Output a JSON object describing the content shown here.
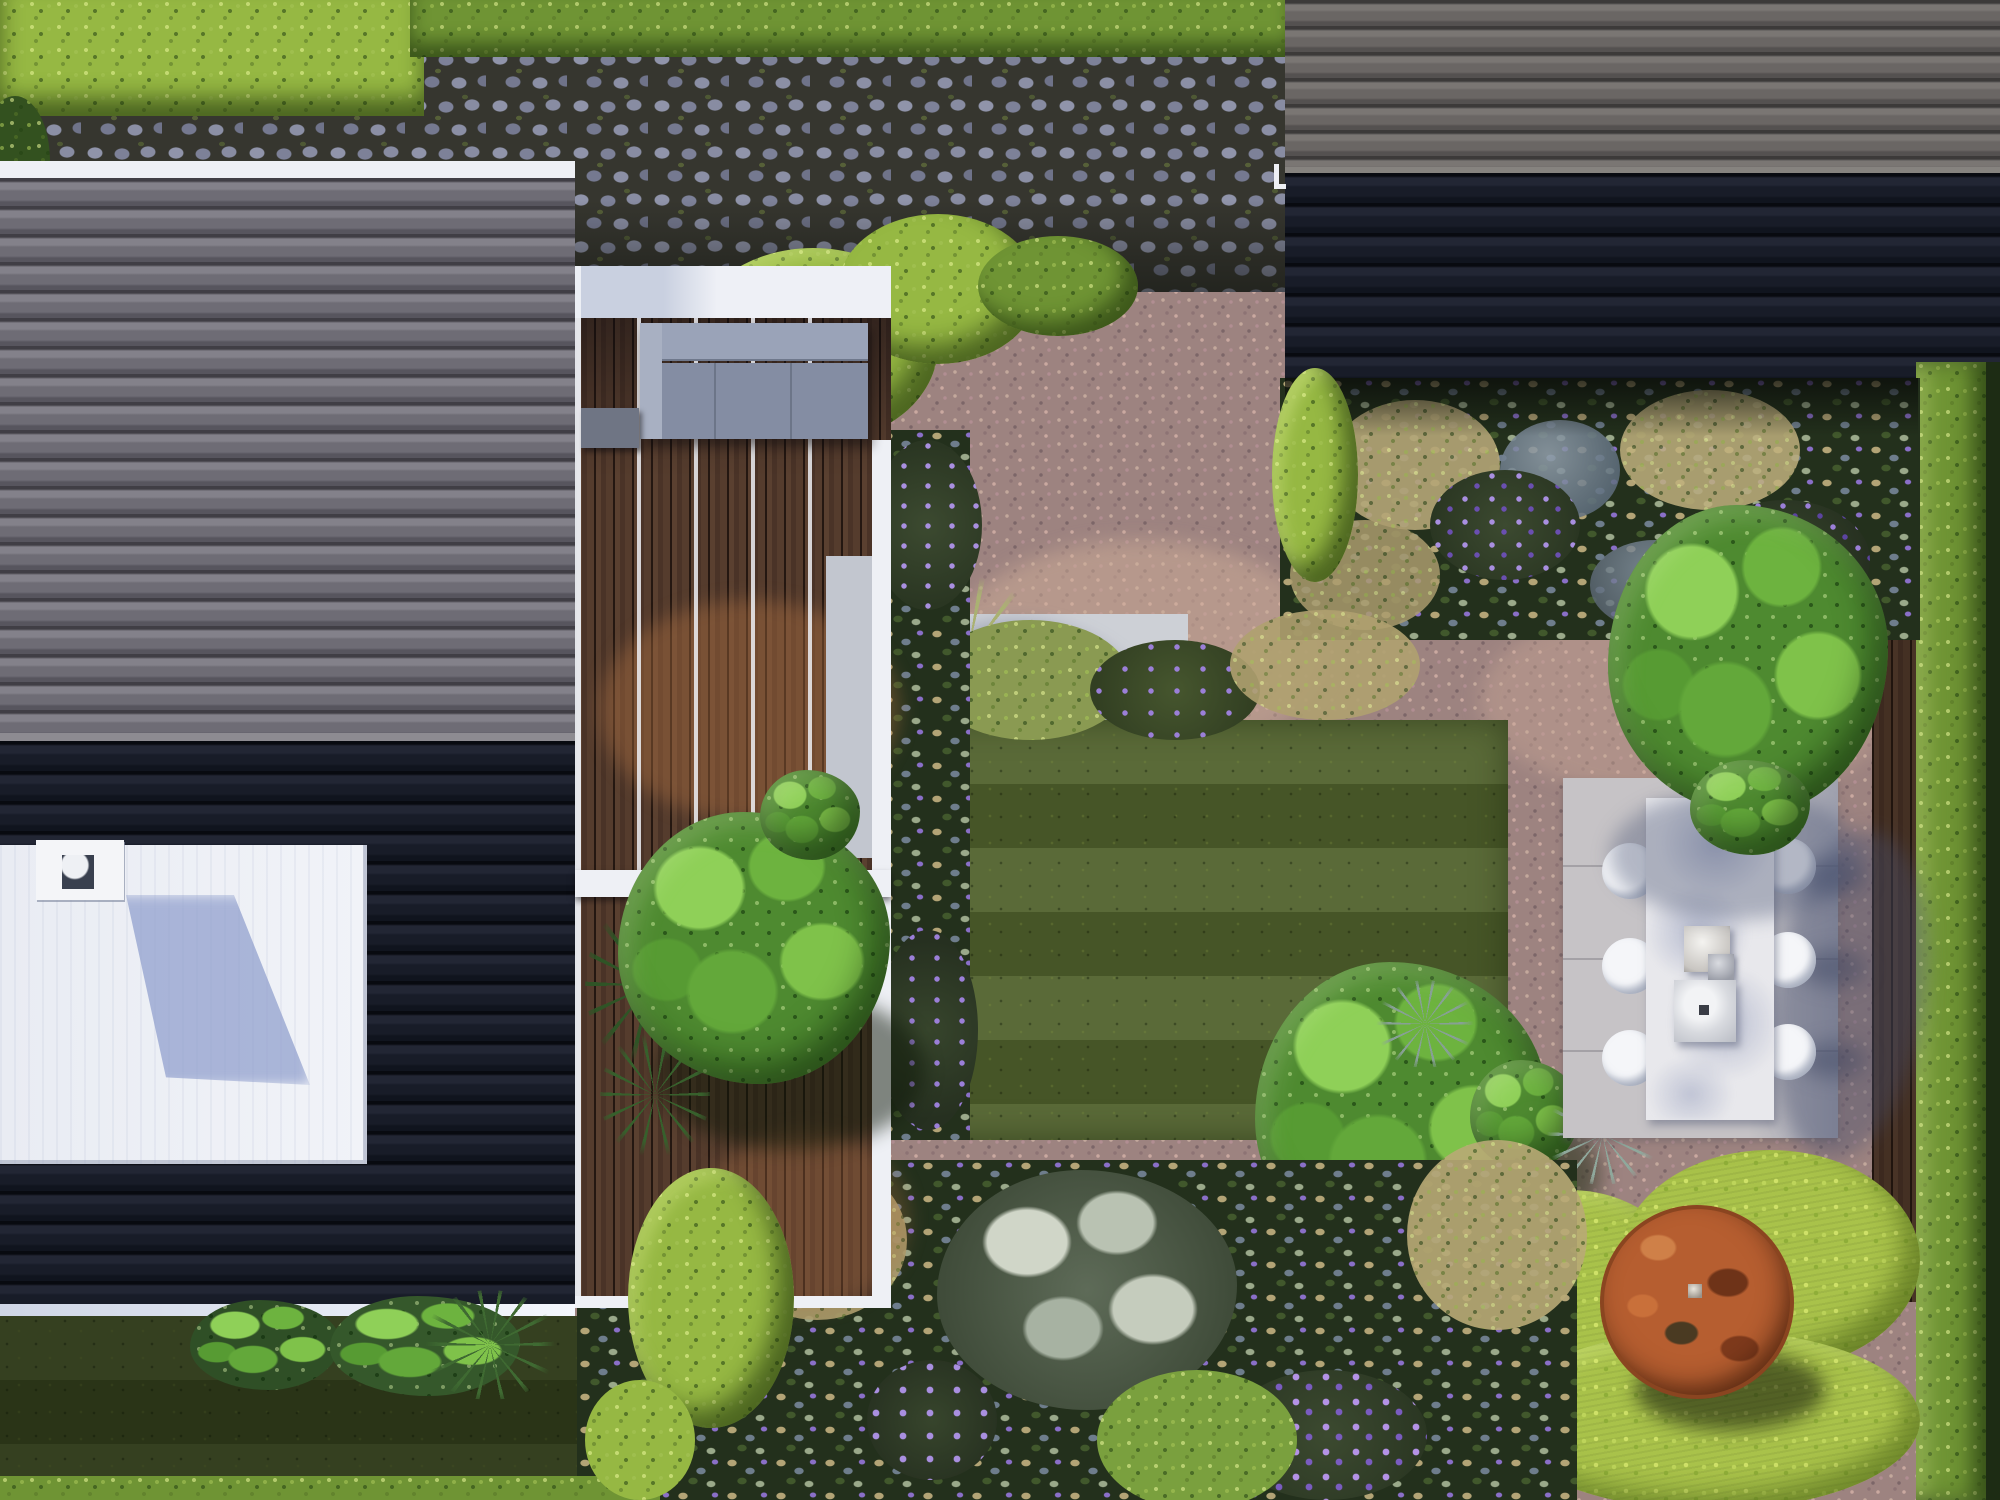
{
  "scene": {
    "title": "Top-down aerial 3D render of a modern backyard garden with black-tiled house roofs, timber pergola deck, gravel garden, striped lawn, outdoor dining patio and corten fire bowl",
    "view": "top-down plan render",
    "time_of_day": "sunny with long shadows cast toward lower right"
  },
  "palette": {
    "house_roof_upper": "#6b6970",
    "house_roof_shaded": "#161a23",
    "neighbor_roof_upper": "#676462",
    "flat_roof_white": "#eef0f5",
    "deck_timber": "#4c362a",
    "pergola_white": "#f2f4f8",
    "cobblestone": "#8b8fa5",
    "gravel_pink": "#9d8380",
    "lawn_green": "#50612c",
    "hedge_bright": "#96b843",
    "moss_chartreuse": "#a9c24a",
    "corten_orange": "#b05a2c",
    "lavender_purple": "#8a6fc8",
    "concrete_pale": "#c9cbd0",
    "sofa_upholstery": "#8d96ac"
  },
  "elements": {
    "house": {
      "label": "main house roof",
      "tile_type": "S-profile concrete tiles",
      "ridge": "horizontal",
      "flat_roof": "white single-storey extension",
      "chimney_vents": 1,
      "gutters": 2
    },
    "neighbor_building": {
      "label": "neighboring roof top right",
      "gutter_mark": 1
    },
    "deck": {
      "label": "covered timber terrace",
      "pergola_beams": 4,
      "crossbeam": 1,
      "sofa": 1,
      "side_table": 1,
      "tree": 1
    },
    "steps": {
      "label": "concrete stepping slabs",
      "slab_count": 3,
      "edge_strip": 1,
      "palm_plants": 2
    },
    "lawn": {
      "label": "striped mown lawn",
      "stripe_direction": "horizontal",
      "bush": 1,
      "yucca_rosettes": 3
    },
    "dining": {
      "label": "gravel-set concrete dining patio",
      "table": 1,
      "chairs": 6,
      "tableware_items": 3,
      "pad_joints": 3,
      "tree": 1
    },
    "fire_feature": {
      "label": "corten steel fire bowl",
      "count": 1,
      "center_drain": 1,
      "setting": "chartreuse moss mounds"
    },
    "hedges": {
      "top_left_block": 1,
      "top_strip": 1,
      "cloud_hedge": 1,
      "mound_hedge": 1,
      "right_boundary_column": 1,
      "bottom_strip": 1,
      "bottom_mound": 1
    },
    "planting": {
      "upper_bed": "wheat grasses, silver foliage, lavender",
      "left_strip": "perennials along deck",
      "bottom_border": "silver foliage, purple flowers, grasses",
      "ferns": 1
    },
    "paving": {
      "cobblestone_court": 1,
      "timber_fence_band": 1
    }
  }
}
